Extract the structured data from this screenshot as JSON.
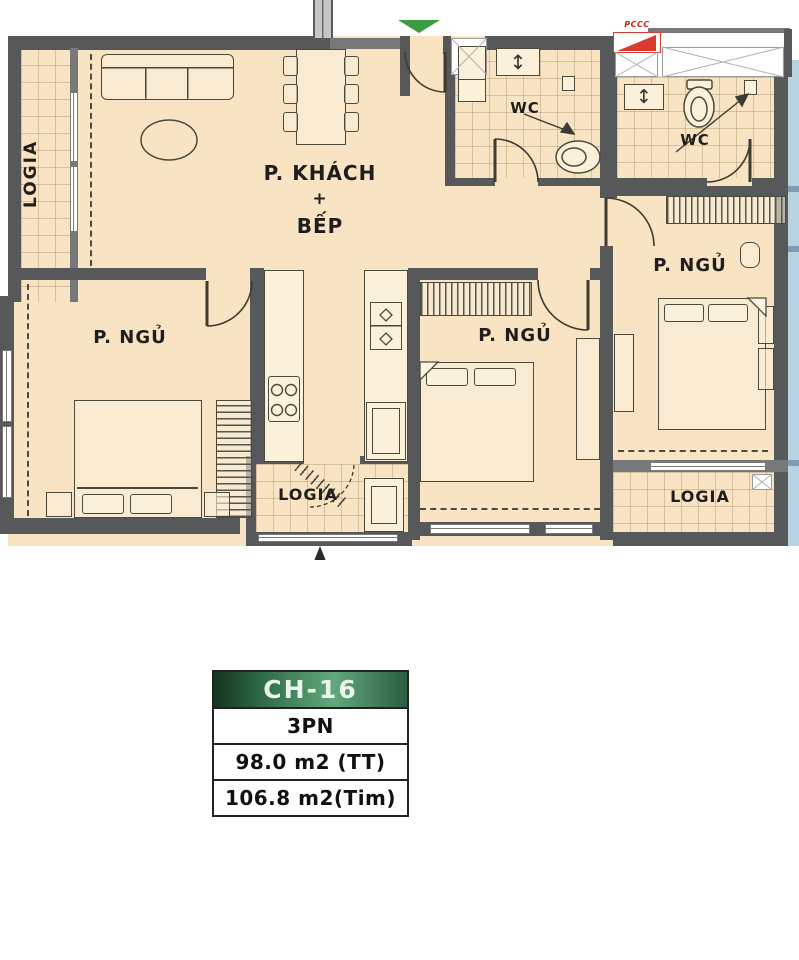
{
  "plan": {
    "labels": {
      "logia_left": "LOGIA",
      "living_line1": "P. KHÁCH",
      "living_line2": "+",
      "living_line3": "BẾP",
      "wc_left": "WC",
      "wc_right": "WC",
      "pccc": "PCCC",
      "bedroom_left": "P. NGỦ",
      "bedroom_middle": "P. NGỦ",
      "bedroom_right": "P. NGỦ",
      "logia_center": "LOGIA",
      "logia_right": "LOGIA"
    },
    "icons": {
      "faucet": "↕"
    }
  },
  "info_card": {
    "unit_code": "CH-16",
    "bedroom_count": "3PN",
    "area_usable": "98.0 m2 (TT)",
    "area_gross": "106.8 m2(Tim)"
  },
  "colors": {
    "floor": "#f8e3c2",
    "wall": "#57585a",
    "entrance_arrow_green": "#3d9b41",
    "pccc_red": "#d93c2e",
    "card_header_green_dark": "#14341f",
    "card_header_green_light": "#63a87c",
    "adjacent_blue": "#b7d3e2"
  }
}
